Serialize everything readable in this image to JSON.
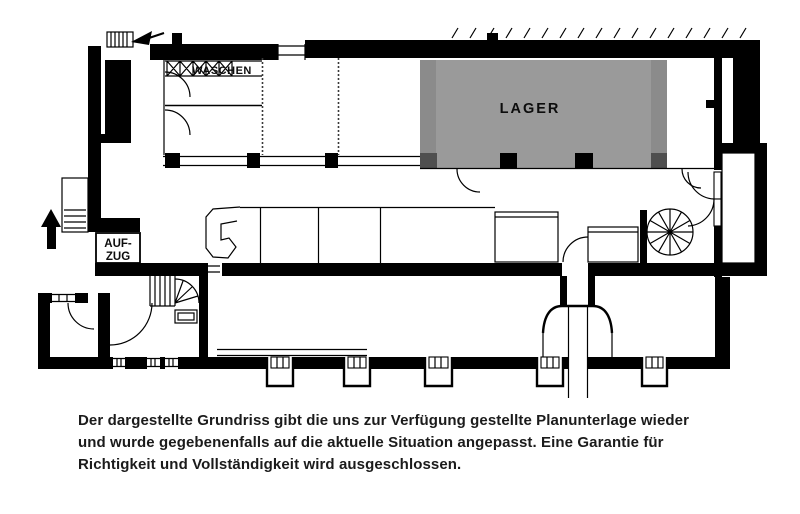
{
  "plan": {
    "labels": {
      "storage": "LAGER",
      "washing": "WASCHEN",
      "elevator_line1": "AUF-",
      "elevator_line2": "ZUG"
    },
    "colors": {
      "wall": "#000000",
      "storage_fill": "#9a9a9a",
      "background": "#ffffff"
    },
    "icons": {
      "north_arrow": "↑",
      "entry_arrow": "◄",
      "washing_machine": "⊠",
      "spiral_staircase": "spiral-stair-glyph",
      "straight_staircase": "stair-treads-glyph"
    }
  },
  "disclaimer": {
    "lines": [
      "Der dargestellte Grundriss gibt die uns zur Verfügung gestellte Planunterlage wieder",
      "und wurde gegebenenfalls auf die aktuelle Situation angepasst. Eine Garantie für",
      "Richtigkeit und Vollständigkeit wird ausgeschlossen."
    ]
  }
}
